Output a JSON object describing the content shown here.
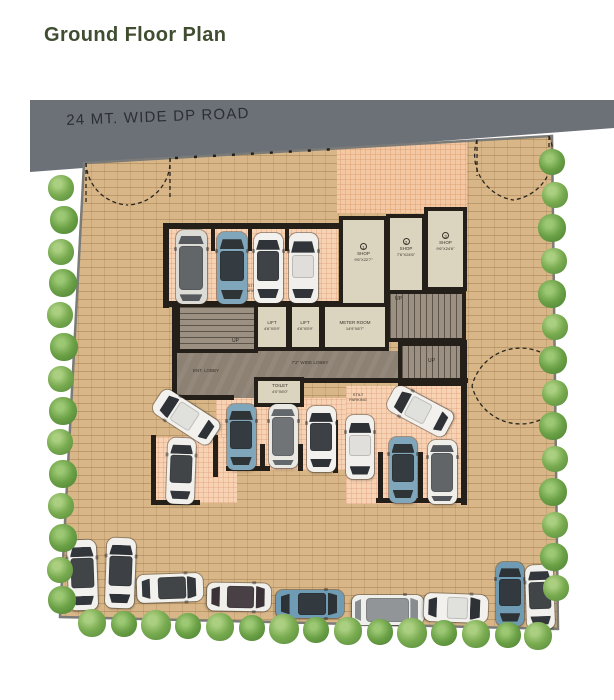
{
  "title": "Ground Floor Plan",
  "road": {
    "label": "24 MT. WIDE DP ROAD"
  },
  "colors": {
    "title_green": "#404d31",
    "road_gray": "#6c7077",
    "paving_tan": "#d8b687",
    "parking_pink": "#f7d3b4",
    "room_beige": "#dbd4bf",
    "wall_dark": "#241f18",
    "tree_green": "#6aa045",
    "car_blue": "#7fa6ba"
  },
  "rooms": {
    "shop1": {
      "num": "1",
      "name": "SHOP",
      "dims": "9'6\"X22'7\""
    },
    "shop2": {
      "num": "2",
      "name": "SHOP",
      "dims": "7'6\"X24'6\""
    },
    "shop3": {
      "num": "3",
      "name": "SHOP",
      "dims": "9'6\"X24'6\""
    },
    "lift1": {
      "name": "LIFT",
      "dims": "4'6\"X5'9\""
    },
    "lift2": {
      "name": "LIFT",
      "dims": "4'6\"X5'9\""
    },
    "meter_room": {
      "name": "METER ROOM",
      "dims": "14'9\"X8'7\""
    },
    "toilet": {
      "name": "TOILET",
      "dims": "4'0\"X6'0\""
    },
    "lobby": {
      "name": "7'2\" WIDE LOBBY"
    },
    "ent_lobby": {
      "name": "ENT. LOBBY"
    },
    "stilt_parking_top": {
      "name": "STILT\nPARKING"
    },
    "stilt_parking_bottom": {
      "name": "STILT\nPARKING"
    },
    "up_label": "UP"
  },
  "cars": [
    {
      "cx": 191,
      "cy": 267,
      "l": 74,
      "w": 31,
      "rot": 0,
      "body": "#dcdbd6",
      "glass": "#565a5e",
      "style": "van"
    },
    {
      "cx": 232,
      "cy": 268,
      "l": 72,
      "w": 30,
      "rot": 0,
      "body": "#7fa6ba",
      "glass": "#2f3437",
      "style": "coupe"
    },
    {
      "cx": 268,
      "cy": 268,
      "l": 70,
      "w": 29,
      "rot": 0,
      "body": "#f2f1ed",
      "glass": "#303439",
      "style": "coupe"
    },
    {
      "cx": 303,
      "cy": 268,
      "l": 70,
      "w": 29,
      "rot": 0,
      "body": "#f0efeb",
      "glass": "#303439",
      "style": "sedan"
    },
    {
      "cx": 186,
      "cy": 417,
      "l": 68,
      "w": 28,
      "rot": -57,
      "body": "#f2f1ed",
      "glass": "#2e3236",
      "style": "sedan"
    },
    {
      "cx": 181,
      "cy": 471,
      "l": 66,
      "w": 28,
      "rot": 2,
      "body": "#f1f0ec",
      "glass": "#33373b",
      "style": "coupe"
    },
    {
      "cx": 241,
      "cy": 437,
      "l": 66,
      "w": 29,
      "rot": 0,
      "body": "#7fa6ba",
      "glass": "#2f3437",
      "style": "coupe"
    },
    {
      "cx": 283,
      "cy": 436,
      "l": 64,
      "w": 29,
      "rot": 0,
      "body": "#e9e8e3",
      "glass": "#63686c",
      "style": "van"
    },
    {
      "cx": 321,
      "cy": 439,
      "l": 66,
      "w": 29,
      "rot": 0,
      "body": "#f2f1ed",
      "glass": "#2e3236",
      "style": "coupe"
    },
    {
      "cx": 360,
      "cy": 447,
      "l": 64,
      "w": 28,
      "rot": 0,
      "body": "#f1f0ec",
      "glass": "#2e3236",
      "style": "sedan"
    },
    {
      "cx": 420,
      "cy": 411,
      "l": 66,
      "w": 28,
      "rot": -62,
      "body": "#f2f1ed",
      "glass": "#2e3236",
      "style": "sedan"
    },
    {
      "cx": 403,
      "cy": 470,
      "l": 66,
      "w": 28,
      "rot": 0,
      "body": "#7fa6ba",
      "glass": "#2f3437",
      "style": "coupe"
    },
    {
      "cx": 442,
      "cy": 472,
      "l": 64,
      "w": 29,
      "rot": 0,
      "body": "#efeee9",
      "glass": "#53575b",
      "style": "van"
    },
    {
      "cx": 82,
      "cy": 575,
      "l": 70,
      "w": 29,
      "rot": -2,
      "body": "#f2f1ed",
      "glass": "#33373b",
      "style": "coupe"
    },
    {
      "cx": 120,
      "cy": 573,
      "l": 70,
      "w": 29,
      "rot": 2,
      "body": "#f1f0ec",
      "glass": "#2e3236",
      "style": "coupe"
    },
    {
      "cx": 170,
      "cy": 588,
      "l": 66,
      "w": 28,
      "rot": 88,
      "body": "#f2f1ed",
      "glass": "#33373b",
      "style": "coupe"
    },
    {
      "cx": 239,
      "cy": 597,
      "l": 64,
      "w": 28,
      "rot": 91,
      "body": "#f0efeb",
      "glass": "#3a3236",
      "style": "coupe"
    },
    {
      "cx": 310,
      "cy": 604,
      "l": 68,
      "w": 28,
      "rot": 90,
      "body": "#6f9cb4",
      "glass": "#2d3236",
      "style": "coupe"
    },
    {
      "cx": 388,
      "cy": 610,
      "l": 72,
      "w": 30,
      "rot": 90,
      "body": "#eff0ec",
      "glass": "#888c8e",
      "style": "van"
    },
    {
      "cx": 456,
      "cy": 608,
      "l": 64,
      "w": 28,
      "rot": 92,
      "body": "#f2f1ed",
      "glass": "#2e3236",
      "style": "sedan"
    },
    {
      "cx": 510,
      "cy": 594,
      "l": 64,
      "w": 28,
      "rot": 0,
      "body": "#6f9cb4",
      "glass": "#2d3236",
      "style": "coupe"
    },
    {
      "cx": 540,
      "cy": 597,
      "l": 64,
      "w": 28,
      "rot": -2,
      "body": "#f1f0ec",
      "glass": "#33373b",
      "style": "coupe"
    }
  ],
  "trees": [
    {
      "x": 61,
      "y": 188,
      "r": 13,
      "v": 0
    },
    {
      "x": 64,
      "y": 220,
      "r": 14,
      "v": 1
    },
    {
      "x": 61,
      "y": 252,
      "r": 13,
      "v": 0
    },
    {
      "x": 63,
      "y": 283,
      "r": 14,
      "v": 1
    },
    {
      "x": 60,
      "y": 315,
      "r": 13,
      "v": 0
    },
    {
      "x": 64,
      "y": 347,
      "r": 14,
      "v": 1
    },
    {
      "x": 61,
      "y": 379,
      "r": 13,
      "v": 0
    },
    {
      "x": 63,
      "y": 411,
      "r": 14,
      "v": 1
    },
    {
      "x": 60,
      "y": 442,
      "r": 13,
      "v": 0
    },
    {
      "x": 63,
      "y": 474,
      "r": 14,
      "v": 1
    },
    {
      "x": 61,
      "y": 506,
      "r": 13,
      "v": 0
    },
    {
      "x": 63,
      "y": 538,
      "r": 14,
      "v": 1
    },
    {
      "x": 60,
      "y": 570,
      "r": 13,
      "v": 0
    },
    {
      "x": 62,
      "y": 600,
      "r": 14,
      "v": 1
    },
    {
      "x": 92,
      "y": 623,
      "r": 14,
      "v": 0
    },
    {
      "x": 124,
      "y": 624,
      "r": 13,
      "v": 1
    },
    {
      "x": 156,
      "y": 625,
      "r": 15,
      "v": 0
    },
    {
      "x": 188,
      "y": 626,
      "r": 13,
      "v": 1
    },
    {
      "x": 220,
      "y": 627,
      "r": 14,
      "v": 0
    },
    {
      "x": 252,
      "y": 628,
      "r": 13,
      "v": 1
    },
    {
      "x": 284,
      "y": 629,
      "r": 15,
      "v": 0
    },
    {
      "x": 316,
      "y": 630,
      "r": 13,
      "v": 1
    },
    {
      "x": 348,
      "y": 631,
      "r": 14,
      "v": 0
    },
    {
      "x": 380,
      "y": 632,
      "r": 13,
      "v": 1
    },
    {
      "x": 412,
      "y": 633,
      "r": 15,
      "v": 0
    },
    {
      "x": 444,
      "y": 633,
      "r": 13,
      "v": 1
    },
    {
      "x": 476,
      "y": 634,
      "r": 14,
      "v": 0
    },
    {
      "x": 508,
      "y": 635,
      "r": 13,
      "v": 1
    },
    {
      "x": 538,
      "y": 636,
      "r": 14,
      "v": 0
    },
    {
      "x": 552,
      "y": 162,
      "r": 13,
      "v": 1
    },
    {
      "x": 555,
      "y": 195,
      "r": 13,
      "v": 0
    },
    {
      "x": 552,
      "y": 228,
      "r": 14,
      "v": 1
    },
    {
      "x": 554,
      "y": 261,
      "r": 13,
      "v": 0
    },
    {
      "x": 552,
      "y": 294,
      "r": 14,
      "v": 1
    },
    {
      "x": 555,
      "y": 327,
      "r": 13,
      "v": 0
    },
    {
      "x": 553,
      "y": 360,
      "r": 14,
      "v": 1
    },
    {
      "x": 555,
      "y": 393,
      "r": 13,
      "v": 0
    },
    {
      "x": 553,
      "y": 426,
      "r": 14,
      "v": 1
    },
    {
      "x": 555,
      "y": 459,
      "r": 13,
      "v": 0
    },
    {
      "x": 553,
      "y": 492,
      "r": 14,
      "v": 1
    },
    {
      "x": 555,
      "y": 525,
      "r": 13,
      "v": 0
    },
    {
      "x": 554,
      "y": 557,
      "r": 14,
      "v": 1
    },
    {
      "x": 556,
      "y": 588,
      "r": 13,
      "v": 0
    }
  ]
}
